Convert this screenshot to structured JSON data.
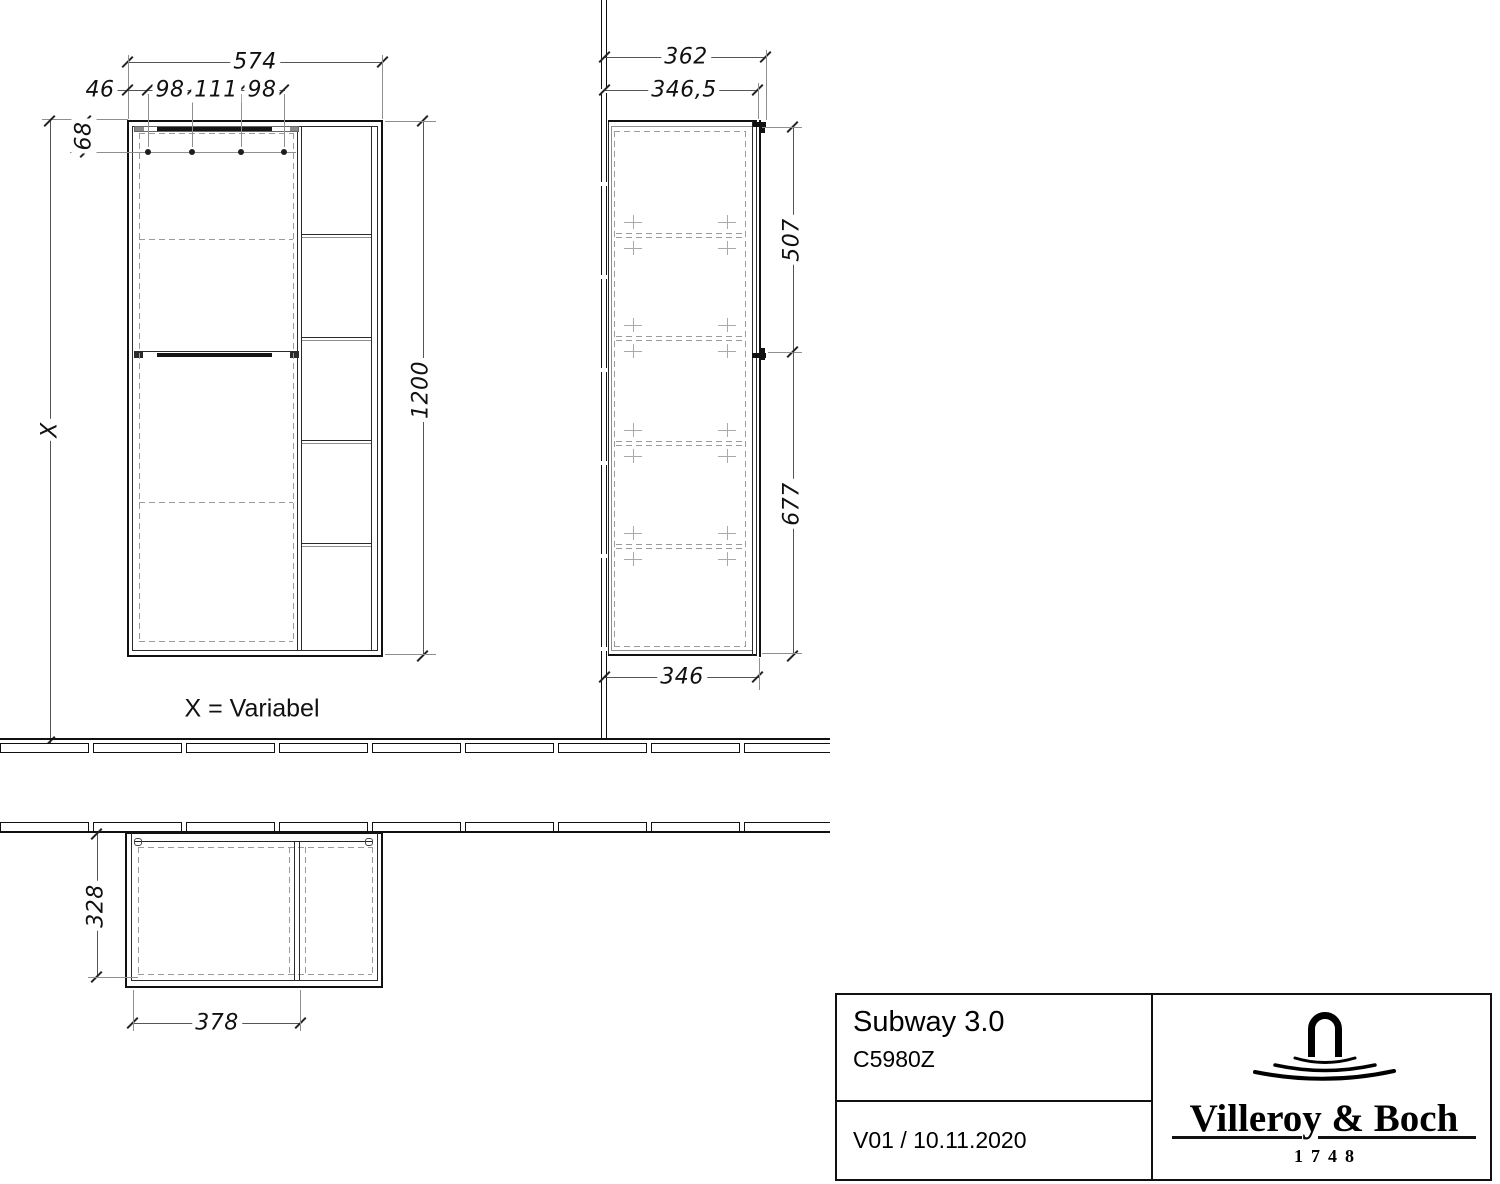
{
  "front_view": {
    "dim_width_total": "574",
    "dim_hole_spacings": [
      "46",
      "98",
      "111",
      "98"
    ],
    "dim_holes_from_top": "68",
    "dim_height": "1200",
    "dim_floor_distance": "X",
    "note": "X = Variabel"
  },
  "side_view": {
    "dim_depth_overall": "362",
    "dim_depth_top": "346,5",
    "dim_upper_section": "507",
    "dim_lower_section": "677",
    "dim_depth_bottom": "346"
  },
  "bottom_view": {
    "dim_carcass_depth": "328",
    "dim_door_width": "378"
  },
  "title_block": {
    "product_name": "Subway 3.0",
    "article_number": "C5980Z",
    "version_date": "V01 / 10.11.2020",
    "brand_name": "Villeroy & Boch",
    "brand_year": "1748"
  },
  "colors": {
    "line": "#111111",
    "dim_line": "#555555",
    "dashed": "#9b9b9b",
    "background": "#ffffff"
  }
}
